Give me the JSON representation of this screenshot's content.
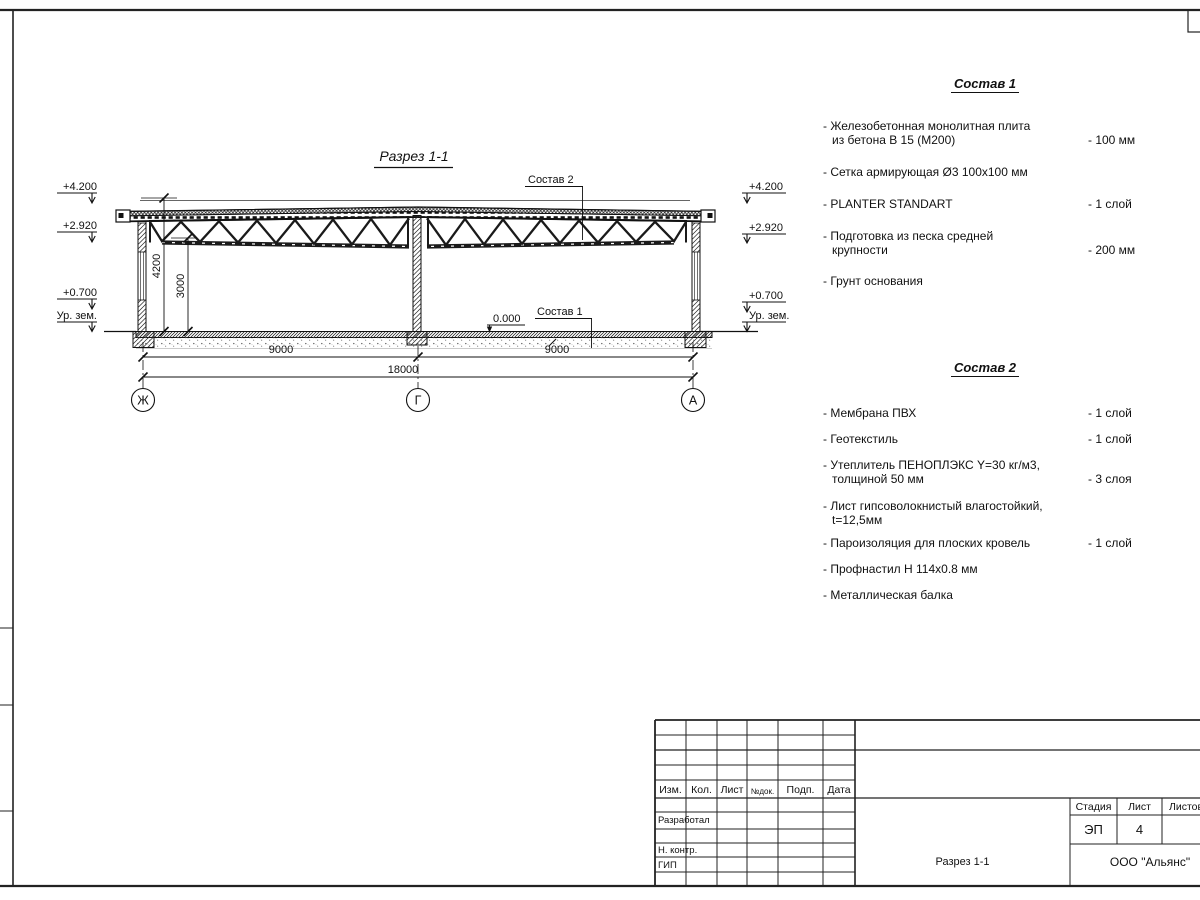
{
  "drawing": {
    "title": "Разрез 1-1",
    "levels": [
      "+4.200",
      "+2.920",
      "+0.700",
      "Ур. зем."
    ],
    "zero": "0.000",
    "dims": [
      "9000",
      "9000",
      "18000"
    ],
    "vdims": [
      "4200",
      "3000"
    ],
    "axes": [
      "Ж",
      "Г",
      "А"
    ],
    "callouts": [
      "Состав 1",
      "Состав 2"
    ]
  },
  "lists": [
    {
      "title": "Состав 1",
      "items": [
        {
          "lines": [
            "- Железобетонная  монолитная плита",
            "из бетона В 15 (М200)"
          ],
          "value": "- 100 мм"
        },
        {
          "lines": [
            "- Сетка армирующая Ø3 100х100 мм"
          ],
          "value": ""
        },
        {
          "lines": [
            "- PLANTER STANDART"
          ],
          "value": "-  1 слой"
        },
        {
          "lines": [
            "- Подготовка из песка средней",
            "крупности"
          ],
          "value": "- 200 мм"
        },
        {
          "lines": [
            "- Грунт основания"
          ],
          "value": ""
        }
      ]
    },
    {
      "title": "Состав 2",
      "items": [
        {
          "lines": [
            "- Мембрана ПВХ"
          ],
          "value": "- 1 слой"
        },
        {
          "lines": [
            "- Геотекстиль"
          ],
          "value": "- 1 слой"
        },
        {
          "lines": [
            "- Утеплитель ПЕНОПЛЭКС Y=30 кг/м3,",
            "толщиной 50 мм"
          ],
          "value": "- 3 слоя"
        },
        {
          "lines": [
            "- Лист гипсоволокнистый влагостойкий,",
            "t=12,5мм"
          ],
          "value": ""
        },
        {
          "lines": [
            "- Пароизоляция для плоских кровель"
          ],
          "value": "- 1 слой"
        },
        {
          "lines": [
            "- Профнастил Н 114х0.8 мм"
          ],
          "value": ""
        },
        {
          "lines": [
            "- Металлическая балка"
          ],
          "value": ""
        }
      ]
    }
  ],
  "title_block": {
    "cols": [
      "Изм.",
      "Кол.",
      "Лист",
      "№док.",
      "Подп.",
      "Дата"
    ],
    "roles": [
      "Разработал",
      "Н. контр.",
      "ГИП"
    ],
    "stage_cols": [
      "Стадия",
      "Лист",
      "Листов"
    ],
    "stage": "ЭП",
    "sheet": "4",
    "doc_title": "Разрез 1-1",
    "company": "ООО \"Альянс\""
  }
}
